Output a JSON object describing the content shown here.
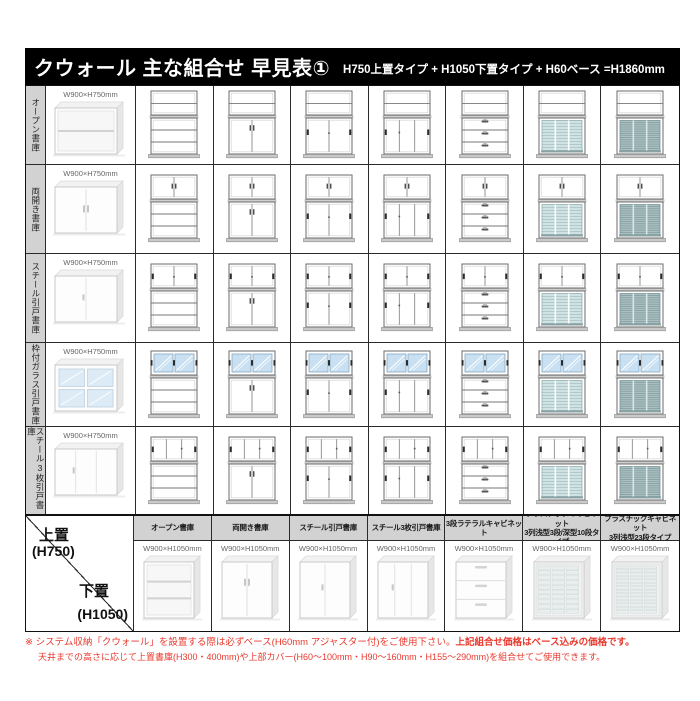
{
  "title": {
    "main": "クウォール 主な組合せ 早見表①",
    "sub": "H750上置タイプ + H1050下置タイプ + H60ベース =H1860mm"
  },
  "upper_table": {
    "size_label": "W900×H750mm",
    "rows": [
      {
        "label": "オープン書庫",
        "type": "open"
      },
      {
        "label": "両開き書庫",
        "type": "hinged"
      },
      {
        "label": "スチール引戸書庫",
        "type": "sliding2"
      },
      {
        "label": "枠付ガラス引戸書庫",
        "type": "glass2"
      },
      {
        "label": "スチール3枚引戸書庫",
        "type": "sliding3"
      }
    ]
  },
  "lower_table": {
    "upper_label": "上置",
    "upper_size": "(H750)",
    "lower_label": "下置",
    "lower_size": "(H1050)",
    "size_label": "W900×H1050mm",
    "columns": [
      {
        "label": "オープン書庫",
        "type": "open"
      },
      {
        "label": "両開き書庫",
        "type": "hinged"
      },
      {
        "label": "スチール引戸書庫",
        "type": "sliding2"
      },
      {
        "label": "スチール3枚引戸書庫",
        "type": "sliding3"
      },
      {
        "label": "3段ラテラルキャビネット",
        "type": "lateral3"
      },
      {
        "label": "プラスチックキャビネット\n3列浅型3段/深型10段タイプ",
        "type": "plastic10"
      },
      {
        "label": "プラスチックキャビネット\n3列浅型23段タイプ",
        "type": "plastic23"
      }
    ]
  },
  "footnote": {
    "line1_normal": "※ システム収納「クウォール」を設置する際は必ずベース(H60mm アジャスター付)をご使用下さい。",
    "line1_bold": "上記組合せ価格はベース込みの価格です。",
    "line2": "天井までの高さに応じて上置書庫(H300・400mm)や上部カバー(H60〜100mm・H90〜160mm・H155〜290mm)を組合せてご使用できます。"
  },
  "colors": {
    "accent_red": "#e8392e",
    "header_gray": "#d2d2d2",
    "border_black": "#111111",
    "glass_blue": "#c8e0f2",
    "plastic_light": "#cfe3e5",
    "plastic_dark": "#a9c0c2",
    "base_gray": "#c9c9c9"
  }
}
